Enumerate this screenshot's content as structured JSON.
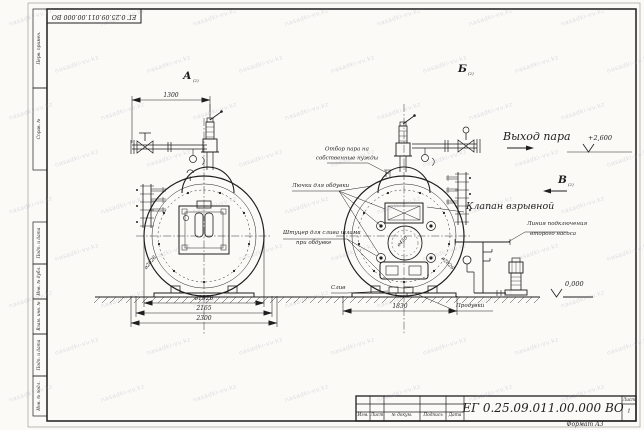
{
  "document": {
    "number": "ЕГ 0.25.09.011.00.000  ВО",
    "sheet_label": "Лист",
    "sheet_number": "1",
    "format_note": "Формат А3"
  },
  "frame": {
    "left_cells": [
      "Перв. примен.",
      "Справ. №",
      "Подп. и дата",
      "Инв. № дубл.",
      "Взам. инв. №",
      "Подп. и дата",
      "Инв. № подл."
    ]
  },
  "title_block": {
    "columns": [
      "Изм.",
      "Лист",
      "№ докум.",
      "Подпись",
      "Дата"
    ]
  },
  "views": {
    "a": "А",
    "b": "Б",
    "v": "В",
    "sub": "(2)"
  },
  "dimensions": {
    "pipe_span": "1300",
    "shell_dia": "ø1920",
    "saddle_span": "2165",
    "base_span": "2300",
    "right_base_span": "1830",
    "outer_dia": "ø2026",
    "manhole_dia": "ø450"
  },
  "elevations": {
    "steam_outlet": "+2,600",
    "ground": "0,000"
  },
  "annotations": {
    "steam_outlet": "Выход пара",
    "explosion_valve": "Клапан взрывной",
    "own_needs_line1": "Отбор пара на",
    "own_needs_line2": "собственные нужды",
    "soot_hatches": "Лючки для обдувки",
    "sludge_line1": "Штуцер для слива шлама",
    "sludge_line2": "при обдувке",
    "drain": "Слив",
    "blowdown": "Продувки",
    "pump_line1": "Линия подключения",
    "pump_line2": "второго насоса"
  },
  "watermark": {
    "text": "nasadki-vv.kz"
  },
  "colors": {
    "ink": "#1e1e1e",
    "paper": "#fbfaf7",
    "watermark": "#8d93ab"
  }
}
